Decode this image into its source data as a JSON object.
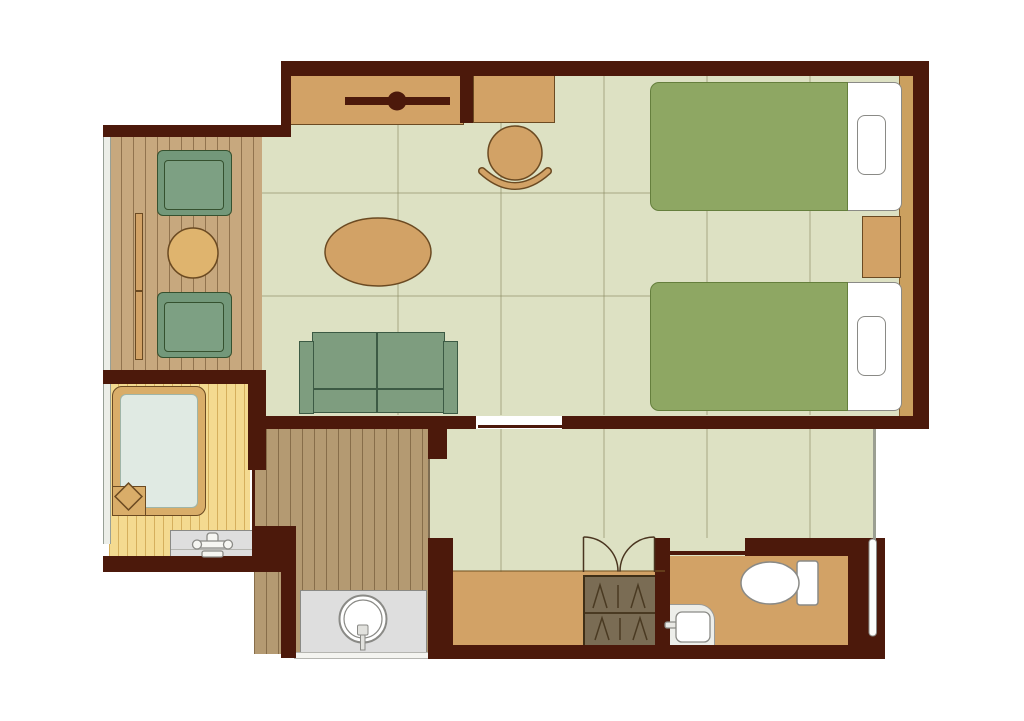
{
  "document": {
    "kind": "hotel-room-floor-plan",
    "visible_text": []
  },
  "colors": {
    "wall": "#4c190b",
    "floor": "#dde1c3",
    "deck_wood": "#c7a87e",
    "corridor_wood": "#b49a72",
    "bath_wood": "#f4da90",
    "furniture_tan": "#d2a266",
    "furniture_outline": "#6b4a22",
    "headboard_tan": "#cba05f",
    "bed_green": "#8ea763",
    "bed_green_outline": "#657f3d",
    "upholstery_green": "#7e9d7f",
    "upholstery_outline": "#3c5a44",
    "chair_green": "#73987a",
    "tub_frame": "#d9ad69",
    "tub_water": "#e0eae3",
    "counter_gray": "#dedede",
    "fixture_stroke": "#8a8a86",
    "closet_fill": "#7a6c54",
    "closet_line": "#4a3a22"
  },
  "components": {
    "rooms": [
      "balcony-deck",
      "main-bedroom",
      "bathroom",
      "vanity-corridor",
      "entry-hall",
      "genkan-entry",
      "toilet-room"
    ],
    "furniture": [
      "tv-console",
      "tv-icon",
      "writing-desk",
      "desk-chair",
      "oval-table",
      "two-seat-sofa",
      "balcony-chair",
      "balcony-chair",
      "balcony-round-table",
      "twin-bed",
      "twin-bed",
      "pillow",
      "pillow",
      "nightstand",
      "headboard-panel",
      "hanger-closet"
    ],
    "fixtures": [
      "bathtub",
      "bath-faucet",
      "bath-counter",
      "round-wash-basin",
      "vanity-counter",
      "toilet",
      "toilet-hand-sink",
      "double-closet-doors",
      "entrance-door",
      "bathroom-sliding-door",
      "bedroom-sliding-door"
    ]
  }
}
